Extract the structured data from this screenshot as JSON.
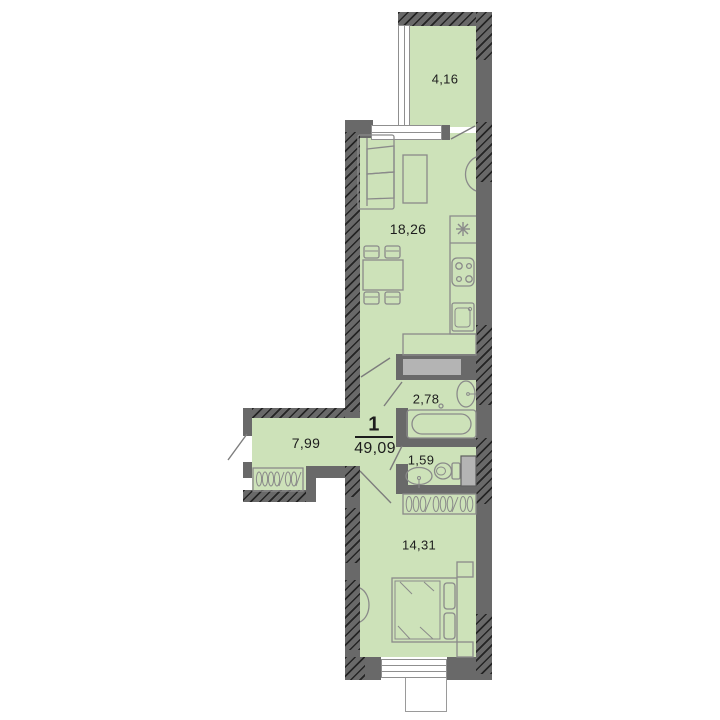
{
  "plan": {
    "apartment": {
      "rooms_count": "1",
      "total_area": "49,09"
    },
    "rooms": {
      "balcony": {
        "name": "balcony",
        "area": "4,16"
      },
      "living_kitchen": {
        "name": "living-kitchen",
        "area": "18,26"
      },
      "bathroom": {
        "name": "bathroom",
        "area": "2,78"
      },
      "hallway": {
        "name": "hallway",
        "area": "7,99"
      },
      "toilet": {
        "name": "toilet",
        "area": "1,59"
      },
      "bedroom": {
        "name": "bedroom",
        "area": "14,31"
      }
    },
    "icons": [
      "sofa",
      "coffee-table",
      "dining-table",
      "chair",
      "kitchen-counter",
      "kitchen-vent-asterisk",
      "stove",
      "kitchen-sink",
      "cabinet",
      "bathtub",
      "washbasin",
      "toilet-bowl",
      "ventilation-duct",
      "wardrobe-hangers",
      "bed",
      "nightstand",
      "radiator",
      "door-leaf",
      "window"
    ]
  },
  "colors": {
    "room_fill": "#cde2b9",
    "wall": "#696969",
    "hatch": "#242424",
    "furniture": "#8a8a8a",
    "duct_fill": "#b4b4b4",
    "window_frame": "#8f8f8f",
    "text": "#1d1d1d",
    "background": "#ffffff",
    "door_line": "#7d7d7d"
  }
}
